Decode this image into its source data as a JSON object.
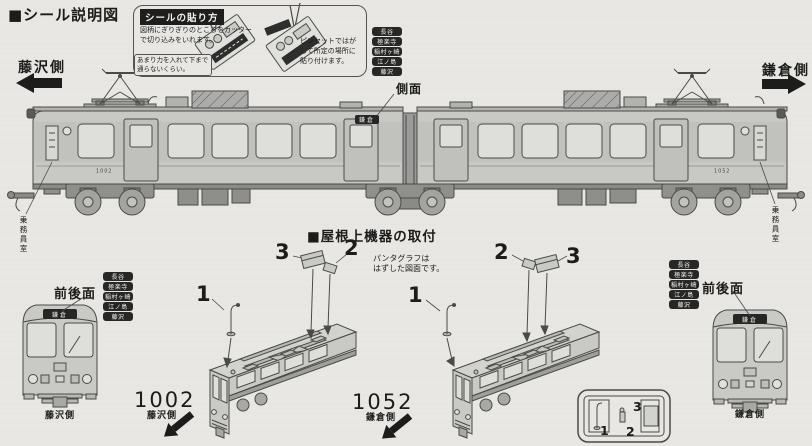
{
  "header": {
    "title": "■シール説明図"
  },
  "howto": {
    "title": "シールの貼り方",
    "step1": "図柄にぎりぎりのところをカッターで切り込みをいれます。",
    "note": "あまり力を入れて下まで通らないくらい。",
    "step2": "ピンセットではがして所定の場所に貼り付けます。"
  },
  "destinations": [
    "長谷",
    "極楽寺",
    "稲村ヶ崎",
    "江ノ島",
    "藤沢"
  ],
  "labels": {
    "side": "側面",
    "front_rear": "前後面",
    "crew": "乗務員室",
    "fujisawa_side": "藤沢側",
    "kamakura_side": "鎌倉側",
    "dest_sign": "鎌倉"
  },
  "train": {
    "left_number": "1002",
    "right_number": "1052"
  },
  "roof": {
    "title": "■屋根上機器の取付",
    "note1": "パンタグラフは",
    "note2": "はずした図面です。",
    "left_view": {
      "p1": "1",
      "p2": "2",
      "p3": "3",
      "car": "1002",
      "side": "藤沢側"
    },
    "right_view": {
      "p1": "1",
      "p2": "2",
      "p3": "3",
      "car": "1052",
      "side": "鎌倉側"
    }
  },
  "tray": {
    "p1": "1",
    "p2": "2",
    "p3": "3"
  }
}
